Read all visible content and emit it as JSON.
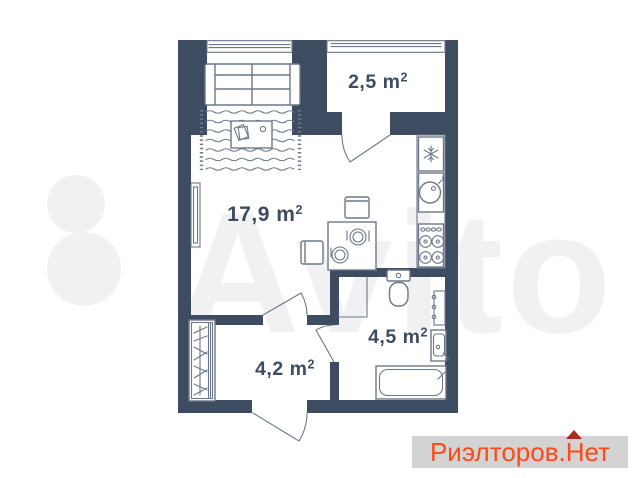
{
  "rooms": {
    "living": {
      "area": "17,9 m",
      "sup": "2"
    },
    "balcony": {
      "area": "2,5 m",
      "sup": "2"
    },
    "bathroom": {
      "area": "4,5 m",
      "sup": "2"
    },
    "hallway": {
      "area": "4,2 m",
      "sup": "2"
    }
  },
  "watermark": {
    "text": "Avito"
  },
  "brand": {
    "name": "Риэлторов.",
    "suffix": "Нет",
    "roof_icon": "roof-triangle"
  },
  "icons": {
    "fridge": "snowflake-icon",
    "sink": "round-sink-icon",
    "stove": "four-burner-stove-icon",
    "wardrobe": "hanger-marks-icon"
  },
  "colors": {
    "wall": "#3d4c61",
    "line": "#6b7889",
    "label": "#3d4c61",
    "watermark": "#f1f1f4",
    "brand_bg": "#d3d3d3",
    "brand_text": "#ff4a17",
    "roof": "#a5301f"
  }
}
